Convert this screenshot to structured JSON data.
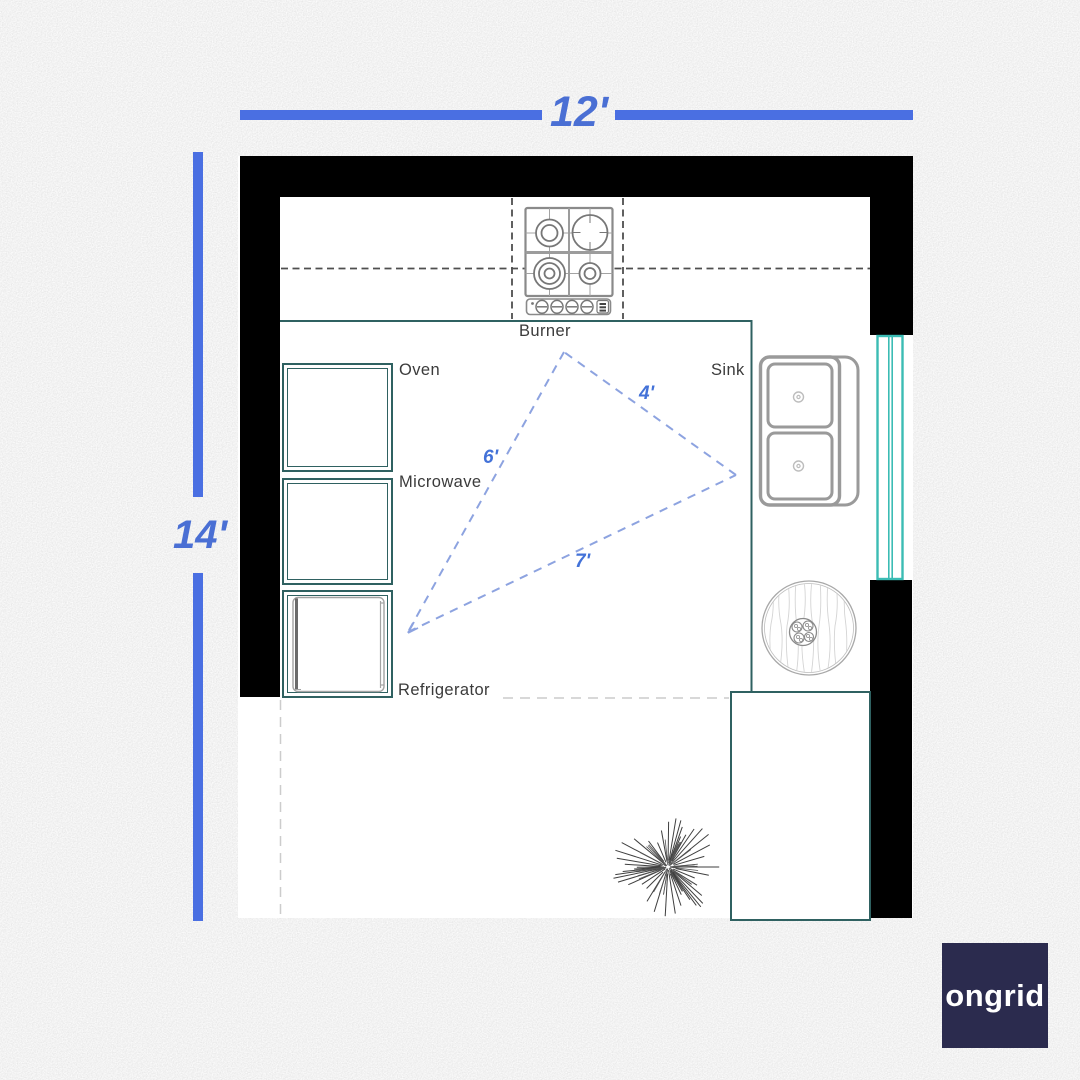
{
  "theme": {
    "bg-gray": "#d8d8d8",
    "accent-blue": "#4a6fe2",
    "dim-text-blue": "#4a6fd4",
    "triangle-blue": "#4372d8",
    "triangle-dash": "#8da3e0",
    "teal-dark": "#2f6161",
    "teal-window": "#3bbcb4",
    "wall-black": "#000000",
    "fixture-gray": "#9a9a9a",
    "label-gray": "#3b3b3b",
    "logo-navy": "#2b2b4e"
  },
  "dimensions": {
    "width_label": "12'",
    "height_label": "14'"
  },
  "work_triangle": {
    "fridge_to_burner": "6'",
    "burner_to_sink": "4'",
    "fridge_to_sink": "7'"
  },
  "labels": {
    "burner": "Burner",
    "oven": "Oven",
    "microwave": "Microwave",
    "refrigerator": "Refrigerator",
    "sink": "Sink"
  },
  "fixtures": [
    "gas-cooktop",
    "oven",
    "microwave",
    "refrigerator",
    "double-basin-sink",
    "window",
    "round-table-with-plant",
    "kitchen-island",
    "floor-plant"
  ],
  "logo": {
    "text": "ongrid"
  }
}
